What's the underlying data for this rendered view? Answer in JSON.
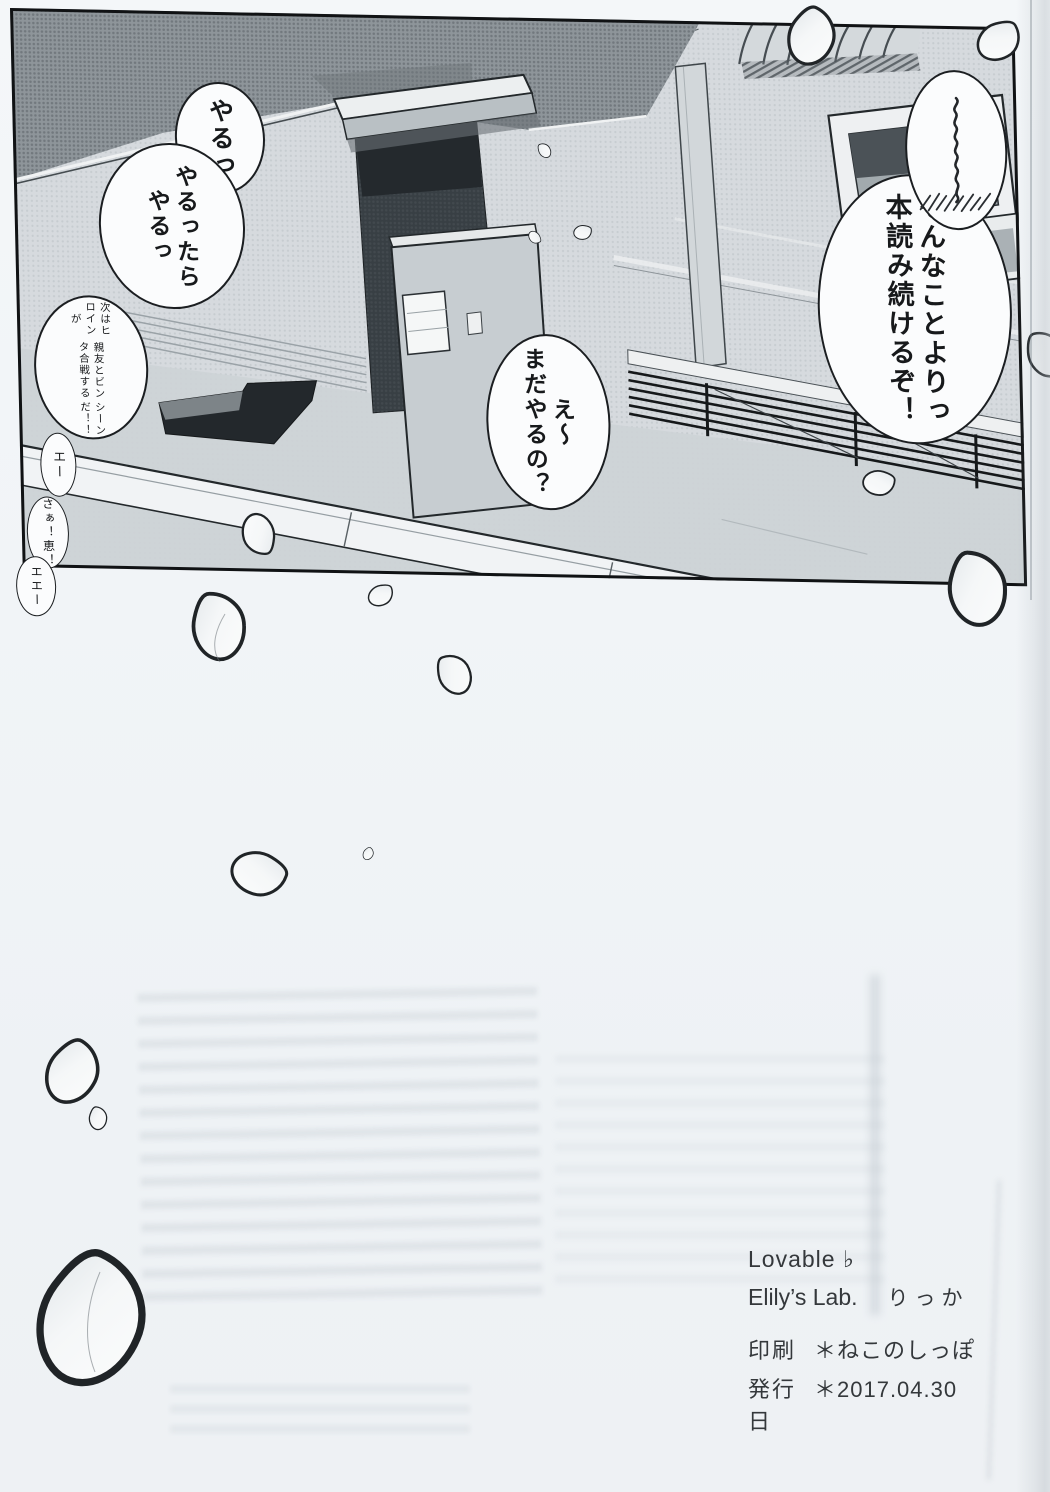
{
  "manga_page": {
    "panel": {
      "bubbles": {
        "yaru_short": "やるっ",
        "yaru_long": "やるったら\nやるっ",
        "handwritten": {
          "col1": "次はヒロインが",
          "col2": "親友とビンタ合戦する",
          "col3": "シーンだ！！"
        },
        "eh_small_1": "エー",
        "saa_megumi": "さぁ！恵！",
        "eh_small_2": "エエー",
        "mada_yaru": "え〜\nまだやるの？",
        "sonna_koto": "そんなことよりっ\n本読み続けるぞ！"
      }
    },
    "colophon": {
      "title": "Lovable ♭",
      "circle_name": "Elily’s Lab.",
      "author": "りっか",
      "print_label": "印刷",
      "print_value": "＊ねこのしっぽ",
      "publish_label": "発行日",
      "publish_value": "＊2017.04.30"
    }
  }
}
